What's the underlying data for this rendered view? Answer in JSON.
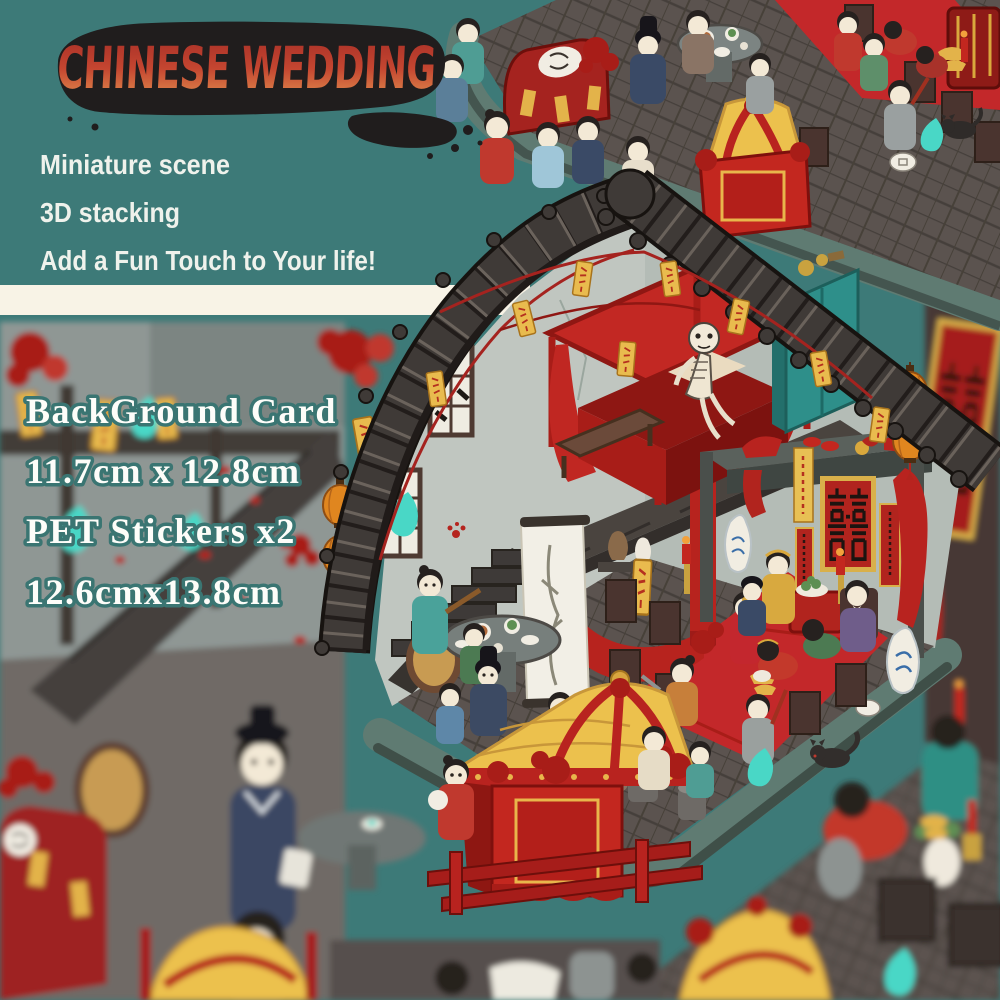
{
  "branding": {
    "logo_text": "CHINESE WEDDING"
  },
  "taglines": {
    "line1": "Miniature scene",
    "line2": "3D stacking",
    "line3": "Add a Fun Touch to Your life!"
  },
  "specs": {
    "line1": "BackGround Card",
    "line2": "11.7cm x 12.8cm",
    "line3": "PET Stickers x2",
    "line4": "12.6cmx13.8cm"
  },
  "illustration": {
    "double_happiness_glyph": "囍",
    "elements": [
      "curved-tile-roof",
      "sloped-tile-roof",
      "canopy-bed",
      "skeleton-figure",
      "teal-wardrobe",
      "loft-floor",
      "red-drapes",
      "double-happiness-banner",
      "couplet-scrolls",
      "wedding-shelf",
      "orange-lanterns",
      "paper-talismans",
      "staircase",
      "scroll-painting",
      "bronze-mirror",
      "windows",
      "stone-tables",
      "banquet-guests",
      "red-carpet",
      "wooden-chairs",
      "bridal-sedan-chair",
      "dowry-chest",
      "carrying-poles",
      "black-cat",
      "spirit-flames",
      "porcelain-vases",
      "candle-stands",
      "fruit-plate",
      "coin-charms",
      "base-platform"
    ]
  },
  "palette": {
    "background_teal": "#3d7a78",
    "stripe_cream": "#f8f3e6",
    "logo_black": "#201d1d",
    "logo_red": "#a62f27",
    "logo_orange": "#e2914f",
    "text_white": "#eff2ec",
    "spec_stroke_teal": "#3a7572",
    "scene_red": "#c3272e",
    "scene_dark_red": "#a81d18",
    "scene_gold": "#ecc14d",
    "lantern_orange": "#e0861f",
    "wall_gray": "#c0c6c0",
    "roof_dark": "#3f3a37",
    "floor_dark": "#5b534f",
    "platform_teal": "#5f7b72",
    "flame_teal": "#49d7c6"
  }
}
